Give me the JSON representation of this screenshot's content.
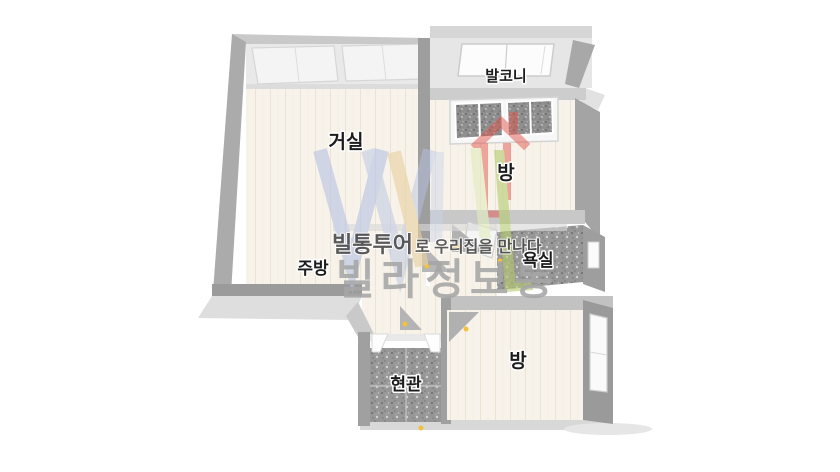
{
  "page": {
    "background": "#ffffff"
  },
  "floorplan": {
    "rooms": [
      {
        "id": "living-room",
        "label": "거실"
      },
      {
        "id": "balcony",
        "label": "발코니"
      },
      {
        "id": "bedroom-top",
        "label": "방"
      },
      {
        "id": "kitchen",
        "label": "주방"
      },
      {
        "id": "bathroom",
        "label": "욕실"
      },
      {
        "id": "entrance",
        "label": "현관"
      },
      {
        "id": "bedroom-bottom",
        "label": "방"
      }
    ],
    "colors": {
      "wall_dark": "#9e9e9e",
      "wall_medium": "#ababab",
      "wall_light": "#cbcbcb",
      "wall_top_light": "#d6d6d6",
      "floor_wood": "#f8f3ea",
      "floor_tile_dark": "#979797",
      "balcony_floor": "#e6e6e6",
      "window_white": "#f6f6f7",
      "door_leaf_gray": "#b6b6b6",
      "door_handle_yellow": "#f1c23a",
      "skirt_shadow": "#dedede"
    }
  },
  "watermark": {
    "tagline_brand": "빌통투어",
    "tagline_rest": "로 우리집을 만나다",
    "brand_name": "빌라정보통",
    "tagline_color": "#4a4a4a",
    "brand_color": "#a6a6a6",
    "house_icon_color": "#e2544b",
    "letter_colors": [
      "#b6c3e3",
      "#e9d1a1",
      "#c9d4ea",
      "#e3ecbe",
      "#b5cc70"
    ]
  }
}
